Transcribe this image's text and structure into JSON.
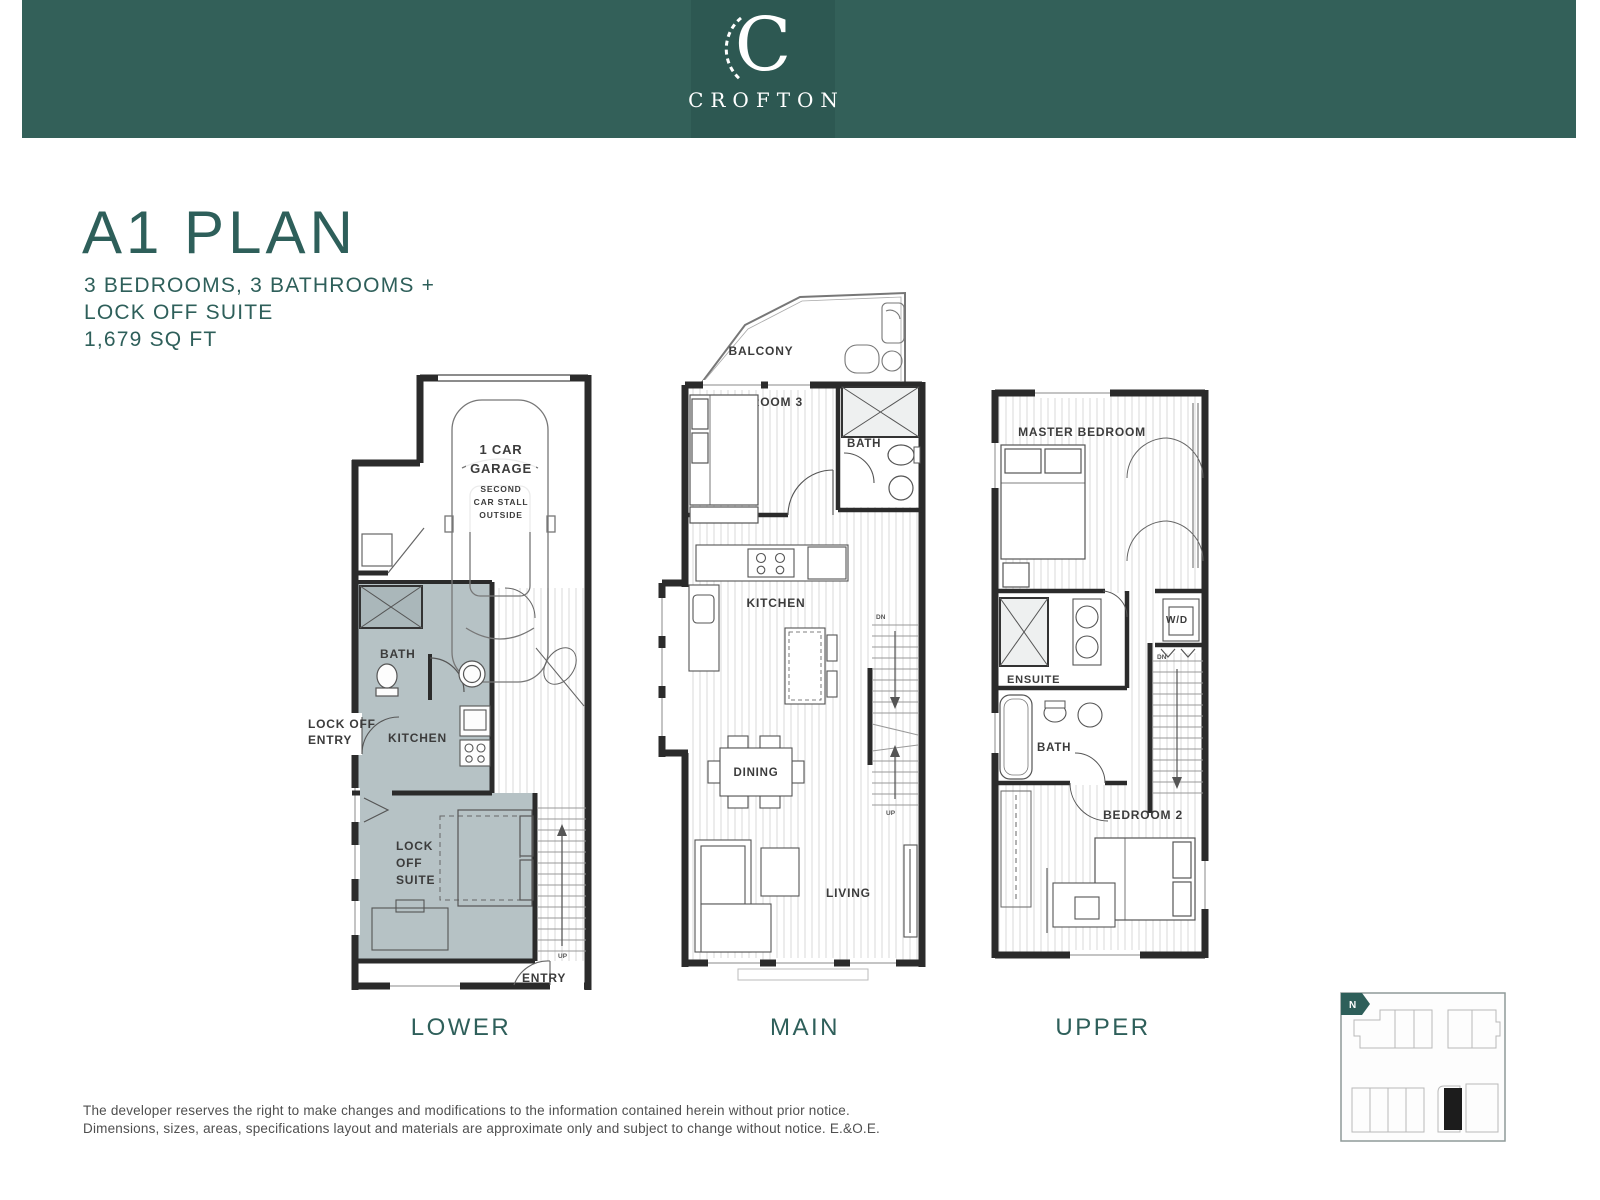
{
  "header": {
    "logo_letter": "C",
    "brand": "CROFTON"
  },
  "plan": {
    "title": "A1 PLAN",
    "subtitle_lines": [
      "3 BEDROOMS, 3 BATHROOMS +",
      "LOCK OFF SUITE",
      "1,679 SQ FT"
    ]
  },
  "floors": {
    "lower": {
      "name": "LOWER",
      "labels": {
        "garage_l1": "1 CAR",
        "garage_l2": "GARAGE",
        "garage_sub": [
          "SECOND",
          "CAR STALL",
          "OUTSIDE"
        ],
        "bath": "BATH",
        "lockoff_entry": [
          "LOCK OFF",
          "ENTRY"
        ],
        "kitchen": "KITCHEN",
        "suite": [
          "LOCK",
          "OFF",
          "SUITE"
        ],
        "entry": "ENTRY",
        "up": "UP"
      }
    },
    "main": {
      "name": "MAIN",
      "labels": {
        "balcony": "BALCONY",
        "bedroom3": "BEDROOM 3",
        "bath": "BATH",
        "kitchen": "KITCHEN",
        "dining": "DINING",
        "living": "LIVING",
        "dn": "DN",
        "up": "UP"
      }
    },
    "upper": {
      "name": "UPPER",
      "labels": {
        "master": "MASTER BEDROOM",
        "wd": "W/D",
        "ensuite": "ENSUITE",
        "bath": "BATH",
        "bedroom2": "BEDROOM 2",
        "dn": "DN"
      }
    }
  },
  "keyplan": {
    "north": "N"
  },
  "disclaimer_lines": [
    "The developer reserves the right to make changes and modifications to the information contained herein without prior notice.",
    "Dimensions, sizes, areas, specifications layout and materials are approximate only and subject to change without notice. E.&O.E."
  ],
  "colors": {
    "header_bg": "#336059",
    "accent": "#2e5f5a",
    "shade": "#b6c2c5",
    "wall": "#2b2b2b"
  }
}
